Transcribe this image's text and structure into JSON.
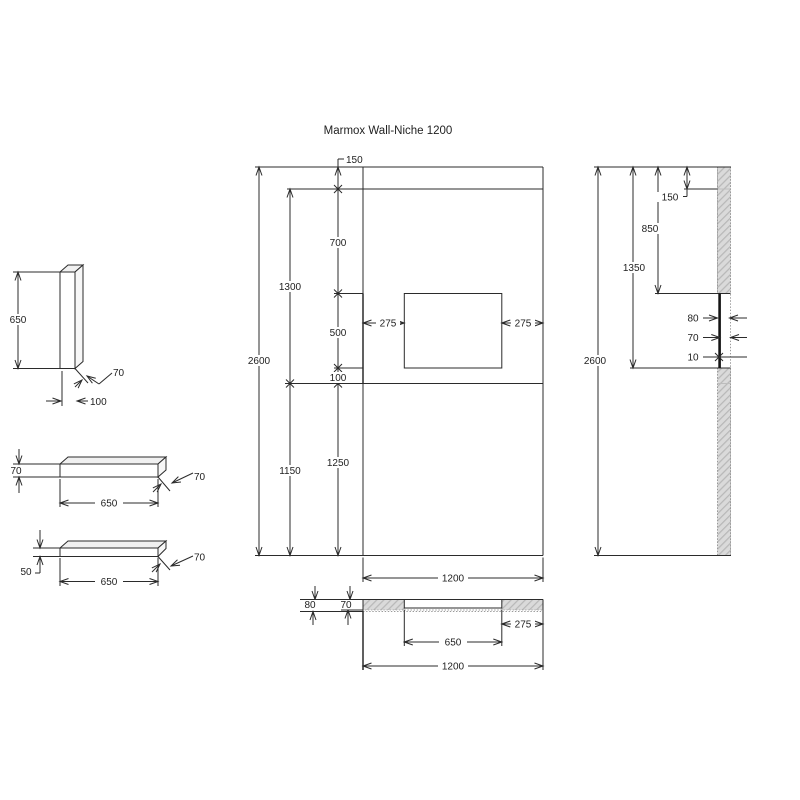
{
  "title": "Marmox Wall-Niche 1200",
  "front_view": {
    "offset_top": "150",
    "joint_to_niche_top": "700",
    "upper_panel_height": "1300",
    "niche_height": "500",
    "niche_margin_left": "275",
    "niche_margin_right": "275",
    "niche_bottom_to_joint": "100",
    "total_height": "2600",
    "floor_to_niche_bottom": "1250",
    "lower_panel_height": "1150",
    "total_width": "1200"
  },
  "plan_section": {
    "total_depth": "80",
    "board_thickness": "70",
    "niche_margin_right": "275",
    "niche_width": "650",
    "total_width": "1200"
  },
  "side_view": {
    "offset_top": "150",
    "joint_to_niche_top": "850",
    "top_to_niche_bottom": "1350",
    "total_height": "2600",
    "total_depth": "80",
    "board_thickness": "70",
    "niche_back_thickness": "10"
  },
  "details": {
    "vertical_board": {
      "height": "650",
      "thickness": "70",
      "width": "100"
    },
    "shelf_70": {
      "thickness": "70",
      "length": "650",
      "depth": "70"
    },
    "shelf_50": {
      "thickness": "50",
      "length": "650",
      "depth": "70"
    }
  },
  "colors": {
    "line": "#2b2b2b",
    "hatch_fill": "#dadada",
    "hatch_stroke": "#b8b8b8",
    "background": "#ffffff"
  }
}
